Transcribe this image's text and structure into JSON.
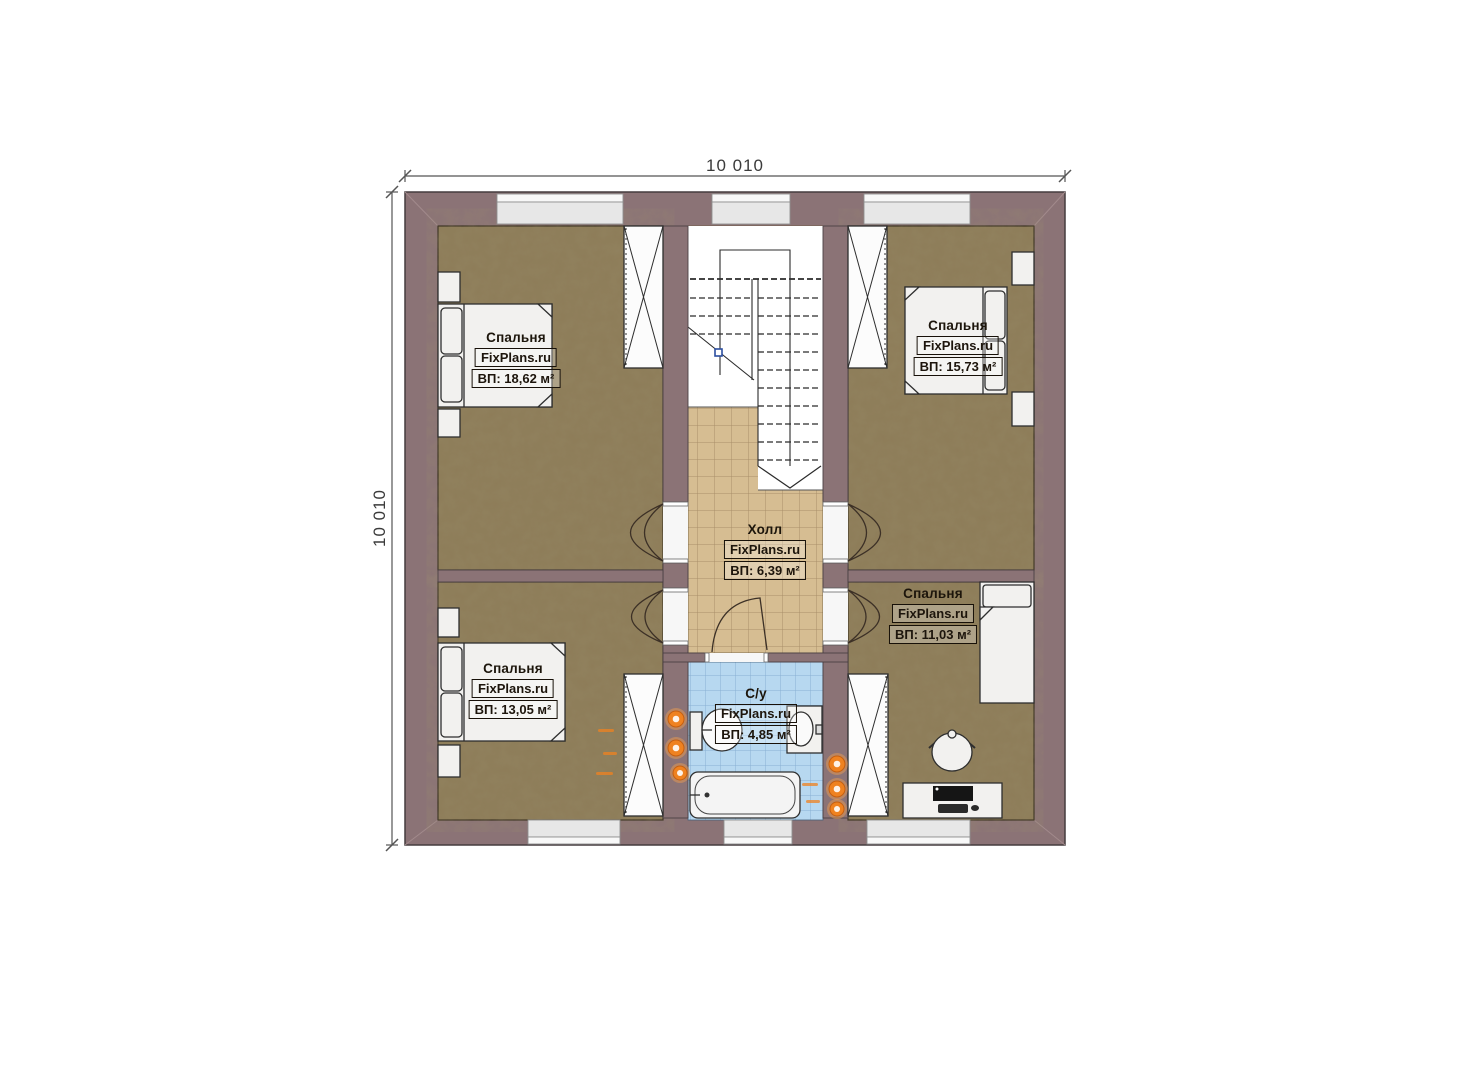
{
  "brand": {
    "watermark": "FixPlans.ru"
  },
  "dimensions": {
    "width_mm": "10 010",
    "height_mm": "10 010"
  },
  "rooms": [
    {
      "id": "bedroom-top-left",
      "name": "Спальня",
      "area": "ВП: 18,62 м²"
    },
    {
      "id": "bedroom-top-right",
      "name": "Спальня",
      "area": "ВП: 15,73 м²"
    },
    {
      "id": "hall",
      "name": "Холл",
      "area": "ВП: 6,39 м²"
    },
    {
      "id": "bedroom-mid-right",
      "name": "Спальня",
      "area": "ВП: 11,03 м²"
    },
    {
      "id": "bedroom-bottom-left",
      "name": "Спальня",
      "area": "ВП: 13,05 м²"
    },
    {
      "id": "bathroom",
      "name": "С/у",
      "area": "ВП: 4,85 м²"
    }
  ],
  "colors": {
    "wall": "#8b7376",
    "bedroom_floor": "#8d7c58",
    "hall_floor": "#d6bd92",
    "bath_floor": "#b7d8f0",
    "heating_accent": "#ef8220",
    "stair_marker": "#2b4ea0"
  }
}
